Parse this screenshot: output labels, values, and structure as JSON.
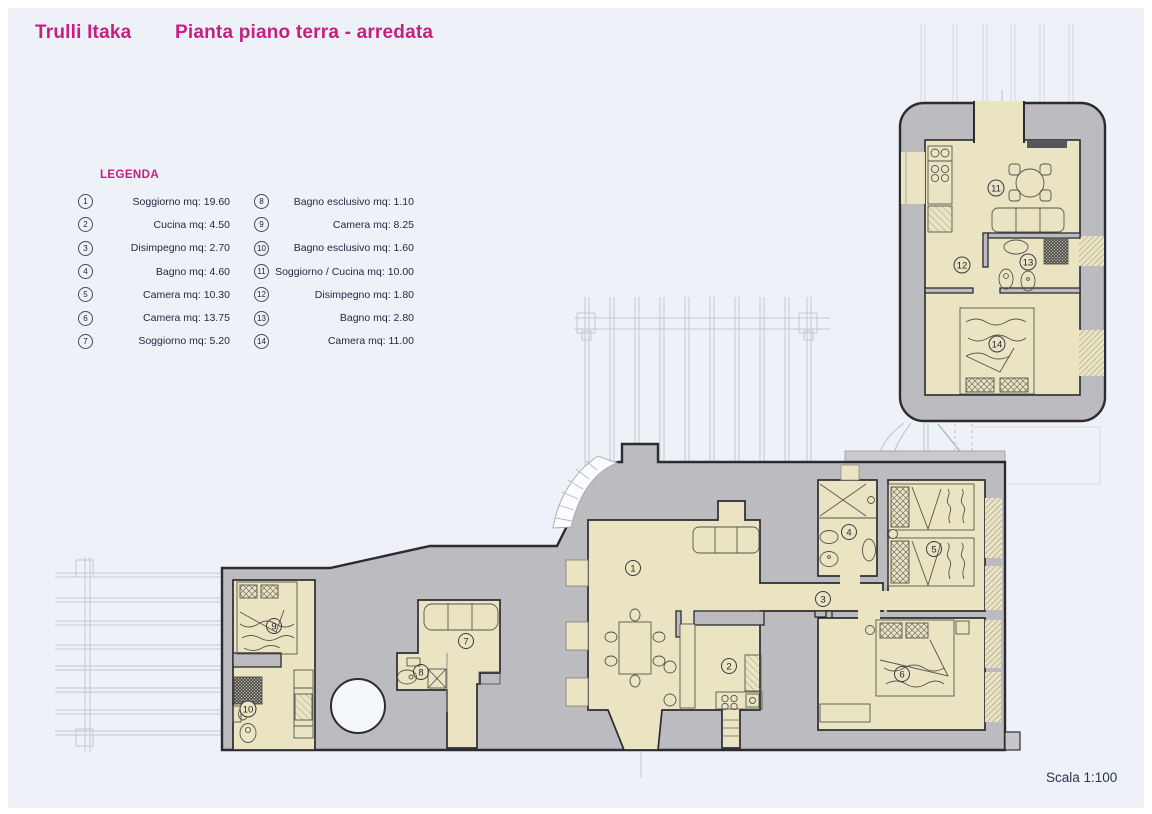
{
  "title": {
    "project": "Trulli Itaka",
    "drawing": "Pianta piano terra - arredata"
  },
  "legend": {
    "heading": "LEGENDA",
    "items": [
      {
        "n": "1",
        "label": "Soggiorno mq: 19.60"
      },
      {
        "n": "2",
        "label": "Cucina mq: 4.50"
      },
      {
        "n": "3",
        "label": "Disimpegno mq: 2.70"
      },
      {
        "n": "4",
        "label": "Bagno mq: 4.60"
      },
      {
        "n": "5",
        "label": "Camera mq: 10.30"
      },
      {
        "n": "6",
        "label": "Camera mq: 13.75"
      },
      {
        "n": "7",
        "label": "Soggiorno mq: 5.20"
      },
      {
        "n": "8",
        "label": "Bagno esclusivo mq: 1.10"
      },
      {
        "n": "9",
        "label": "Camera mq: 8.25"
      },
      {
        "n": "10",
        "label": "Bagno esclusivo mq: 1.60"
      },
      {
        "n": "11",
        "label": "Soggiorno / Cucina mq: 10.00"
      },
      {
        "n": "12",
        "label": "Disimpegno mq: 1.80"
      },
      {
        "n": "13",
        "label": "Bagno mq: 2.80"
      },
      {
        "n": "14",
        "label": "Camera mq: 11.00"
      }
    ]
  },
  "plan": {
    "room_numbers": [
      "1",
      "2",
      "3",
      "4",
      "5",
      "6",
      "7",
      "8",
      "9",
      "10",
      "11",
      "12",
      "13",
      "14"
    ]
  },
  "footer": {
    "scale": "Scala 1:100"
  },
  "colors": {
    "accent": "#c51f82",
    "wall_gray": "#bcbbc0",
    "room_cream": "#ebe4c2",
    "sheet_blue": "#eef2f8",
    "ink": "#2b2b30",
    "legend_text": "#1d2642"
  }
}
